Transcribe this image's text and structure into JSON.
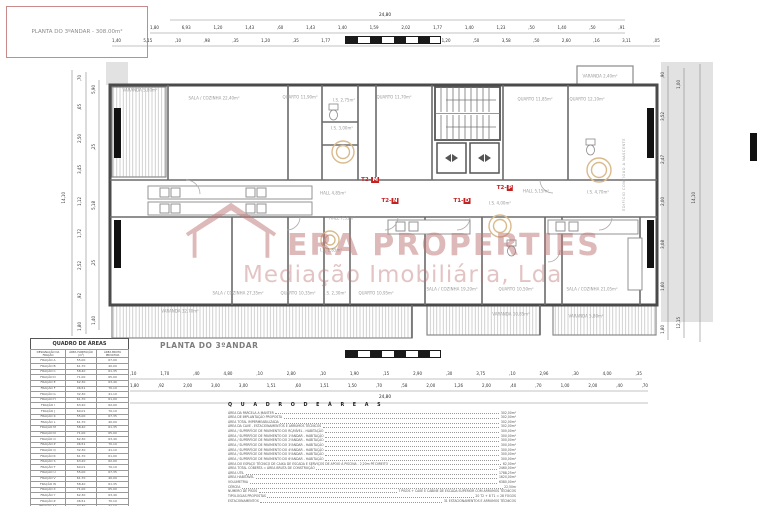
{
  "sheet": {
    "title_box": "PLANTA DO 3ºANDAR - 308.00m²",
    "plan_caption": "PLANTA DO 3ºANDAR",
    "side_note": "EDIFÍCIO CONTÍGUO A NASCENTE"
  },
  "watermark": {
    "brand": "ERA PROPERTIES",
    "subtitle": "Mediação Imobiliária, Lda",
    "color": "#bc7373"
  },
  "colors": {
    "accent_red": "#c42222",
    "wall": "#4a4a4a",
    "title_border": "#c88a8a"
  },
  "plan": {
    "rooms": [
      {
        "label": "VARANDA 5,80m²",
        "x": 140,
        "y": 90
      },
      {
        "label": "SALA / COZINHA 22,40m²",
        "x": 214,
        "y": 98
      },
      {
        "label": "QUARTO 11,90m²",
        "x": 300,
        "y": 97
      },
      {
        "label": "I.S. 2,75m²",
        "x": 344,
        "y": 100
      },
      {
        "label": "I.S. 3,00m²",
        "x": 342,
        "y": 128
      },
      {
        "label": "QUARTO 11,70m²",
        "x": 394,
        "y": 97
      },
      {
        "label": "QUARTO 11,85m²",
        "x": 535,
        "y": 99
      },
      {
        "label": "QUARTO 12,10m²",
        "x": 587,
        "y": 99
      },
      {
        "label": "VARANDA 2,40m²",
        "x": 600,
        "y": 76
      },
      {
        "label": "HALL 4,85m²",
        "x": 333,
        "y": 193
      },
      {
        "label": "HALL 5,15m²",
        "x": 536,
        "y": 191
      },
      {
        "label": "I.S. 4,70m²",
        "x": 598,
        "y": 192
      },
      {
        "label": "HALL 7,35m²",
        "x": 342,
        "y": 218
      },
      {
        "label": "I.S. 1,85m²",
        "x": 331,
        "y": 250
      },
      {
        "label": "I.S. 4,00m²",
        "x": 500,
        "y": 203
      },
      {
        "label": "SALA / COZINHA 27,35m²",
        "x": 238,
        "y": 293
      },
      {
        "label": "QUARTO 10,35m²",
        "x": 298,
        "y": 293
      },
      {
        "label": "I.S. 2,30m²",
        "x": 335,
        "y": 293
      },
      {
        "label": "QUARTO 10,95m²",
        "x": 376,
        "y": 293
      },
      {
        "label": "SALA / COZINHA 19,20m²",
        "x": 452,
        "y": 289
      },
      {
        "label": "QUARTO 10,50m²",
        "x": 516,
        "y": 289
      },
      {
        "label": "SALA / COZINHA 21,05m²",
        "x": 592,
        "y": 289
      },
      {
        "label": "VARANDA 32,70m²",
        "x": 180,
        "y": 311
      },
      {
        "label": "VARANDA 10,85m²",
        "x": 511,
        "y": 314
      },
      {
        "label": "VARANDA 5,80m²",
        "x": 586,
        "y": 316
      }
    ],
    "units": [
      {
        "prefix": "T2-",
        "letter": "M",
        "x": 370,
        "y": 180
      },
      {
        "prefix": "T2-",
        "letter": "N",
        "x": 390,
        "y": 201
      },
      {
        "prefix": "T1-",
        "letter": "D",
        "x": 462,
        "y": 201
      },
      {
        "prefix": "T2-",
        "letter": "P",
        "x": 505,
        "y": 188
      }
    ]
  },
  "dims": {
    "top_total": "24,80",
    "top_row1": [
      "1,80",
      "6,93",
      "1,20",
      "1,43",
      ",60",
      "1,43",
      "1,40",
      "1,59",
      "2,02",
      "1,77",
      "1,40",
      "1,23",
      ",50",
      "1,40",
      ",50",
      ",91"
    ],
    "top_row2": [
      "1,40",
      "5,15",
      ",10",
      ",98",
      ",35",
      "1,20",
      ",35",
      "1,77",
      ",10",
      "2,70",
      ",50",
      "1,20",
      ",50",
      "3,58",
      ",50",
      "2,60",
      ",16",
      "3,11",
      ",05"
    ],
    "bottom_row1": [
      ",10",
      "1,70",
      ",40",
      "4,80",
      ",10",
      "2,80",
      ",10",
      "1,90",
      ",15",
      "2,90",
      ",30",
      "3,75",
      ",10",
      "2,96",
      ",30",
      "4,00",
      ",35"
    ],
    "bottom_row2": [
      "1,80",
      ",92",
      "2,00",
      "3,00",
      "3,00",
      "1,51",
      ",60",
      "1,51",
      "1,50",
      ",70",
      ",58",
      "2,00",
      "1,26",
      "2,00",
      ",40",
      ",70",
      "1,00",
      "2,00",
      ",40",
      ",70"
    ],
    "bottom_total": "24,80",
    "left_outer": "14,10",
    "left_mid": [
      ",70",
      ",65",
      "2,50",
      "3,45",
      "1,12",
      "1,72",
      "2,52",
      ",92",
      "1,80"
    ],
    "left_inner": [
      "5,90",
      ",25",
      "5,18",
      ",25",
      "1,40"
    ],
    "right_inner": [
      ",90",
      "3,52",
      "2,47",
      "2,00",
      "3,08",
      "1,60",
      "1,80"
    ],
    "right_mid": [
      "1,00",
      "12,15"
    ],
    "right_outer": "14,10"
  },
  "areas_table": {
    "title": "QUADRO DE ÁREAS",
    "cols": [
      "DESIGNAÇÃO DA FRAÇÃO",
      "ÁREA HABITAÇÃO (m²)",
      "ÁREA BRUTA PRIVATIVA"
    ],
    "rows": [
      [
        "FRAÇÃO A",
        "55,00",
        "67,00"
      ],
      [
        "FRAÇÃO B",
        "61,70",
        "40,00"
      ],
      [
        "FRAÇÃO C",
        "58,40",
        "61,35"
      ],
      [
        "FRAÇÃO D",
        "71,00",
        "65,00"
      ],
      [
        "FRAÇÃO E",
        "62,30",
        "63,40"
      ],
      [
        "FRAÇÃO F",
        "46,51",
        "70,10"
      ],
      [
        "FRAÇÃO G",
        "32,30",
        "41,10"
      ],
      [
        "FRAÇÃO H",
        "61,70",
        "61,00"
      ],
      [
        "FRAÇÃO I",
        "63,20",
        "62,00"
      ],
      [
        "FRAÇÃO J",
        "60,01",
        "70,10"
      ],
      [
        "FRAÇÃO K",
        "55,00",
        "67,35"
      ],
      [
        "FRAÇÃO L",
        "61,70",
        "40,00"
      ],
      [
        "FRAÇÃO M",
        "58,40",
        "61,35"
      ],
      [
        "FRAÇÃO N",
        "71,00",
        "65,00"
      ],
      [
        "FRAÇÃO O",
        "62,30",
        "63,40"
      ],
      [
        "FRAÇÃO P",
        "46,51",
        "70,10"
      ],
      [
        "FRAÇÃO Q",
        "32,30",
        "41,10"
      ],
      [
        "FRAÇÃO R",
        "61,70",
        "61,00"
      ],
      [
        "FRAÇÃO S",
        "63,20",
        "62,00"
      ],
      [
        "FRAÇÃO T",
        "60,01",
        "70,10"
      ],
      [
        "FRAÇÃO U",
        "55,00",
        "67,35"
      ],
      [
        "FRAÇÃO V",
        "61,70",
        "40,00"
      ],
      [
        "FRAÇÃO W",
        "58,40",
        "61,35"
      ],
      [
        "FRAÇÃO X",
        "71,00",
        "65,00"
      ],
      [
        "FRAÇÃO Y",
        "62,30",
        "63,40"
      ],
      [
        "FRAÇÃO Z",
        "46,51",
        "70,10"
      ],
      [
        "FRAÇÃO AA",
        "32,30",
        "41,10"
      ],
      [
        "FRAÇÃO AB",
        "61,70",
        "61,00"
      ]
    ]
  },
  "areas_list": {
    "title": "Q U A D R O   D E   Á R E A S",
    "items": [
      {
        "label": "ÁREA DA PARCELA A MANTER",
        "value": "302,00m²"
      },
      {
        "label": "ÁREA DE IMPLANTAÇÃO PROPOSTA",
        "value": "302,00m²"
      },
      {
        "label": "ÁREA TOTAL IMPERMEABILIZADA",
        "value": "302,00m²"
      },
      {
        "label": "ÁREA DA CAVE - ESTACIONAMENTOS E ARRUMOS TÉCNICOS",
        "value": "302,00m²"
      },
      {
        "label": "ÁREA / SUPERFÍCIE DE PAVIMENTO DO RC/NÍVEL - HABITAÇÃO",
        "value": "300,00m²"
      },
      {
        "label": "ÁREA / SUPERFÍCIE DE PAVIMENTO DO 1ºANDAR - HABITAÇÃO",
        "value": "300,00m²"
      },
      {
        "label": "ÁREA / SUPERFÍCIE DE PAVIMENTO DO 2ºANDAR - HABITAÇÃO",
        "value": "300,00m²"
      },
      {
        "label": "ÁREA / SUPERFÍCIE DE PAVIMENTO DO 3ºANDAR - HABITAÇÃO",
        "value": "300,00m²"
      },
      {
        "label": "ÁREA / SUPERFÍCIE DE PAVIMENTO DO 4ºANDAR - HABITAÇÃO",
        "value": "300,00m²"
      },
      {
        "label": "ÁREA / SUPERFÍCIE DE PAVIMENTO DO 5ºANDAR - HABITAÇÃO",
        "value": "300,00m²"
      },
      {
        "label": "ÁREA / SUPERFÍCIE DE PAVIMENTO DO 6ºANDAR - HABITAÇÃO",
        "value": "300,00m²"
      },
      {
        "label": "ÁREA DO ESPAÇO TÉCNICO DE CAIXA DE ESCADA E SERVIÇOS DE APOIO À PISCINA - 2,20m PÉ DIREITO",
        "value": "62,00m²"
      },
      {
        "label": "ÁREA TOTAL COBERTA = ÁREA BRUTA DE CONSTRUÇÃO",
        "value": "2460,00m²"
      },
      {
        "label": "ÁREA ÚTIL",
        "value": "1788,25m²"
      },
      {
        "label": "ÁREA HABITÁVEL",
        "value": "1620,00m²"
      },
      {
        "label": "VOLUMETRIA",
        "value": "6380,00m³"
      },
      {
        "label": "CÉRCEA",
        "value": "22,50m"
      },
      {
        "label": "NÚMERO DE PISOS",
        "value": "7 PISOS + CAVE E CABINE DE ESCADA SUPERIOR COM ARRUMOS TÉCNICOS"
      },
      {
        "label": "TIPOLOGIAS PROPOSTAS",
        "value": "20 T2 + 8 T1 = 28 FOGOS"
      },
      {
        "label": "ESTACIONAMENTOS",
        "value": "31 ESTACIONAMENTOS E ARRUMOS TÉCNICOS"
      }
    ]
  }
}
